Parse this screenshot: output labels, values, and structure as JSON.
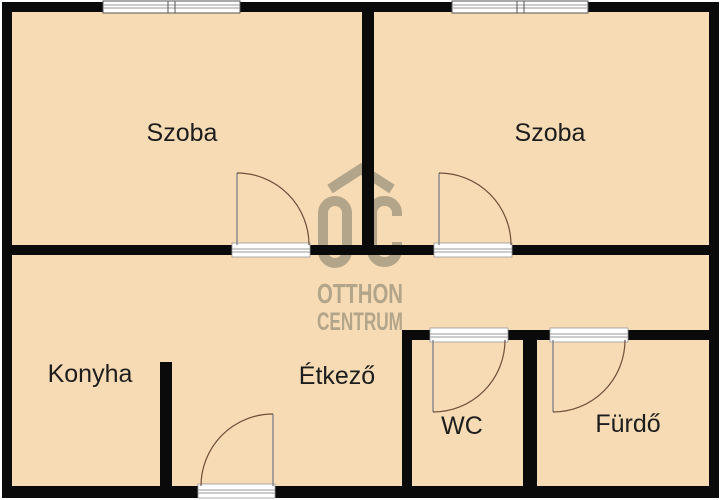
{
  "plan": {
    "type": "floor-plan",
    "rooms": {
      "szoba_left": {
        "label": "Szoba"
      },
      "szoba_right": {
        "label": "Szoba"
      },
      "konyha": {
        "label": "Konyha"
      },
      "etkezo": {
        "label": "Étkező"
      },
      "wc": {
        "label": "WC"
      },
      "furdo": {
        "label": "Fürdő"
      }
    },
    "watermark": {
      "brand_line1": "OTTHON",
      "brand_line2": "CENTRUM"
    },
    "colors": {
      "floor": "#f6dbb4",
      "wall": "#0a0a0a",
      "watermark": "#b3a58a",
      "label_text": "#1d1d1d",
      "door_arc": "#6f4f3a",
      "door_leaf": "#8c8c8c",
      "sill_line": "#9a9a9a"
    },
    "counts": {
      "windows": 2,
      "doors": 5
    }
  }
}
